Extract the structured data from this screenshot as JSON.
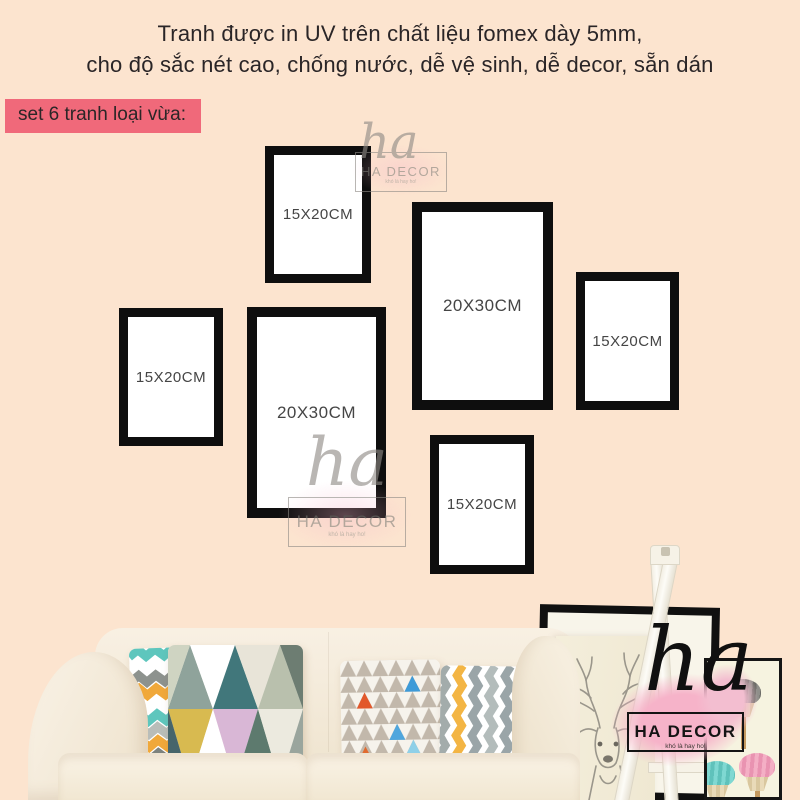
{
  "header": {
    "line1": "Tranh được in UV trên chất liệu fomex dày 5mm,",
    "line2": "cho độ sắc nét cao, chống nước, dễ vệ sinh, dễ decor, sẵn dán"
  },
  "badge": {
    "label": "set 6 tranh loại vừa:"
  },
  "frames": [
    {
      "id": "top-left-frame",
      "label": "15X20CM"
    },
    {
      "id": "top-center-frame",
      "label": "20X30CM"
    },
    {
      "id": "right-frame",
      "label": "15X20CM"
    },
    {
      "id": "left-frame",
      "label": "15X20CM"
    },
    {
      "id": "center-frame",
      "label": "20X30CM"
    },
    {
      "id": "bottom-center-frame",
      "label": "15X20CM"
    }
  ],
  "watermark": {
    "script": "ha",
    "brand": "HA DECOR",
    "tagline": "khó là hay ho!"
  },
  "logo": {
    "script": "ha",
    "brand": "HA DECOR",
    "tagline": "khó là hay ho!"
  },
  "colors": {
    "background": "#fce4cf",
    "badge_background": "#f0697a",
    "frame_border": "#0e0e0e",
    "frame_matte": "#ffffff",
    "header_text": "#2a2527",
    "logo_pink": "#f6b3c9",
    "watermark_gray": "#8f8b86"
  }
}
